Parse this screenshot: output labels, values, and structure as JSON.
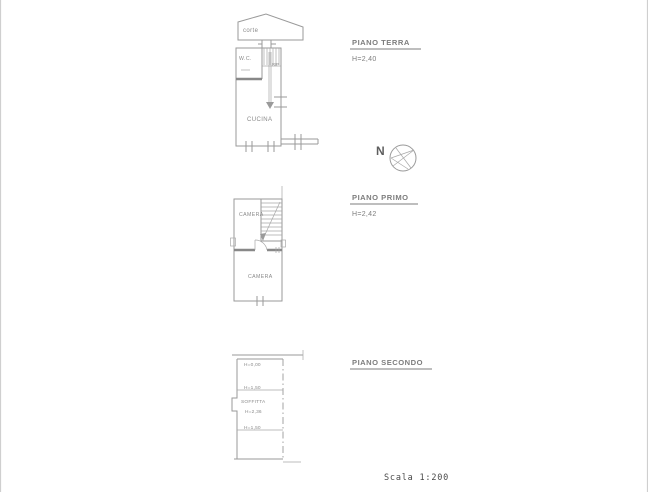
{
  "drawing": {
    "scale_label": "Scala 1:200",
    "compass_label": "N"
  },
  "floors": {
    "terra": {
      "title": "PIANO TERRA",
      "height": "H=2,40",
      "labels": {
        "corte": "corte",
        "wc": "W.C.",
        "rip": "RIP",
        "cucina": "CUCINA"
      }
    },
    "primo": {
      "title": "PIANO PRIMO",
      "height": "H=2,42",
      "labels": {
        "camera_top": "CAMERA",
        "camera_bottom": "CAMERA"
      }
    },
    "secondo": {
      "title": "PIANO SECONDO",
      "labels": {
        "h_eaves": "H=0,00",
        "h_front": "H=1,50",
        "soffitta": "SOFFITTA",
        "h_ridge": "H=2,36",
        "h_back": "H=1,50"
      }
    }
  },
  "colors": {
    "line": "#9a9a9a",
    "wall": "#888888",
    "label_text": "#8a8a8a",
    "title_text": "#7d7d7d",
    "scale_text": "#4a4a4a",
    "background": "#ffffff"
  }
}
